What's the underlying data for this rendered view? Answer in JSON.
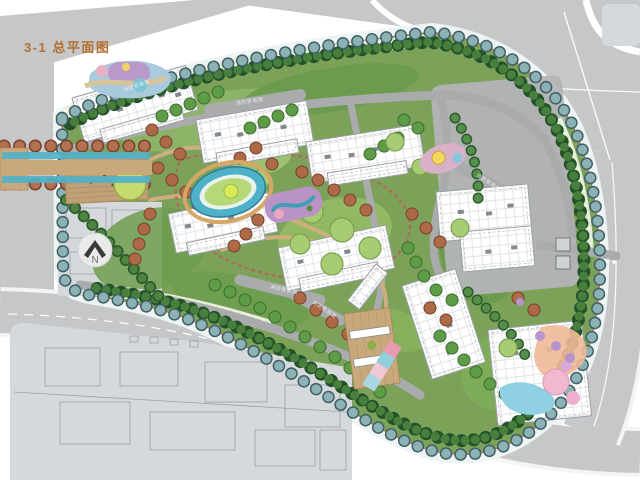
{
  "title": "3-1 总平面图",
  "compass": {
    "north": "N"
  },
  "labels": {
    "fire_lane": "消防登高面"
  },
  "colors": {
    "title_text": "#b5702f",
    "road": "#c6c7c9",
    "context_block": "#d6d9dc",
    "context_line": "#8a93a0",
    "sidewalk": "#eef3f4",
    "site_green": "#7ca158",
    "lawn": "#95bd66",
    "hedge_dark": "#24512a",
    "hedge_light": "#47803d",
    "street_tree_outline": "#3f5f66",
    "street_tree": "#8cb2b6",
    "tree_orange": "#ad6a47",
    "tree_orange_dark": "#7a4030",
    "tree_green": "#5f9c48",
    "tree_light": "#a8cc74",
    "water": "#4fb1c8",
    "island": "#b6d977",
    "deck": "#c2a076",
    "plaza_tan": "#c9a97c",
    "building_fill": "#ffffff",
    "building_line": "#9aa0a6",
    "inner_road": "#a9abad",
    "hatch_strip": "#e6edd6",
    "boundary_red": "#e05050",
    "playground_purple": "#b993c6",
    "playground_blue": "#8fd0e4",
    "playground_pink": "#f2b8d0"
  }
}
